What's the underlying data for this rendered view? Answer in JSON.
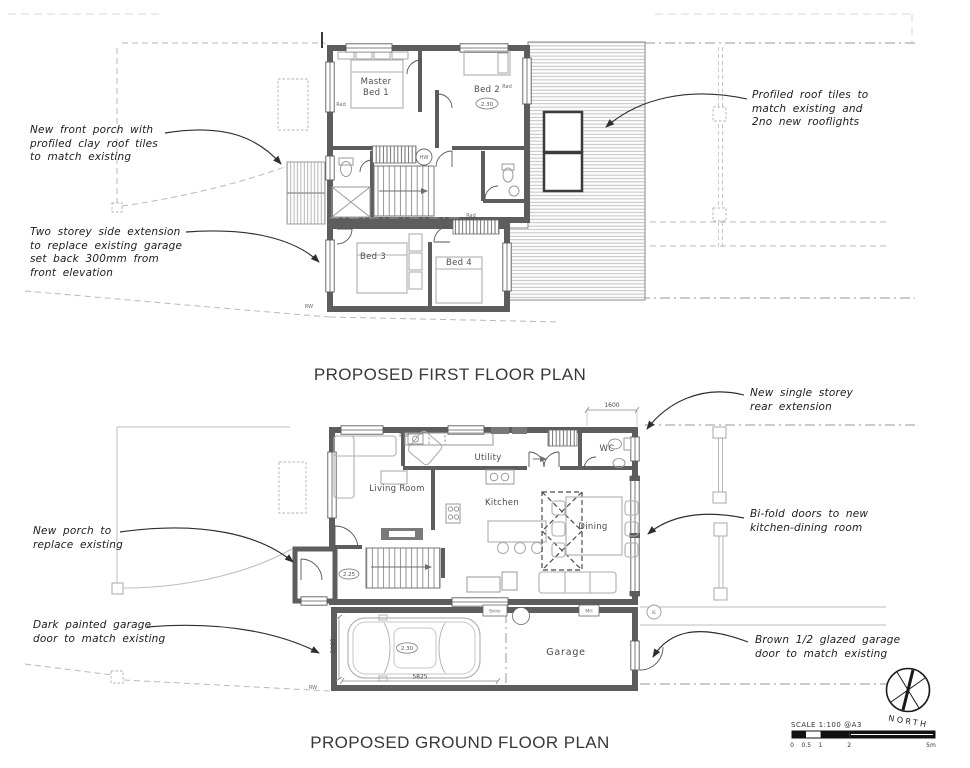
{
  "titles": {
    "first_floor": "PROPOSED FIRST FLOOR PLAN",
    "ground_floor": "PROPOSED GROUND FLOOR PLAN"
  },
  "annotations": {
    "front_porch": "New front porch with\nprofiled clay roof tiles\nto match existing",
    "side_extension": "Two storey side extension\nto replace existing garage\nset back 300mm from\nfront elevation",
    "roof_tiles": "Profiled roof tiles to\nmatch existing and\n2no new rooflights",
    "rear_extension": "New single storey\nrear extension",
    "bifold_doors": "Bi-fold doors to new\nkitchen-dining room",
    "new_porch": "New porch to\nreplace existing",
    "garage_door_dark": "Dark painted garage\ndoor to match existing",
    "garage_door_brown": "Brown 1/2 glazed garage\ndoor to match existing"
  },
  "first_floor": {
    "rooms": {
      "master_line1": "Master",
      "master_line2": "Bed 1",
      "bed2": "Bed 2",
      "bed3": "Bed 3",
      "bed4": "Bed 4"
    },
    "markers": {
      "bed2_height": "2.30",
      "hw": "HW",
      "rad": "Rad",
      "rw": "RW"
    }
  },
  "ground_floor": {
    "rooms": {
      "living": "Living Room",
      "utility": "Utility",
      "wc": "WC",
      "kitchen": "Kitchen",
      "dining": "Dining",
      "garage": "Garage"
    },
    "markers": {
      "hall_height": "2.25",
      "garage_height": "2.30",
      "boiler": "Boiler",
      "mh": "MH",
      "ie": "IE",
      "rad": "Rad",
      "rw": "RW"
    },
    "dimensions": {
      "rear": "1600",
      "garage_width": "5825",
      "garage_depth": "3065"
    }
  },
  "scale": {
    "label": "SCALE 1:100 @A3",
    "ticks": [
      "0",
      "0.5",
      "1",
      "2",
      "5m"
    ]
  },
  "north": {
    "label": "NORTH"
  },
  "colors": {
    "wall": "#5d5d5d",
    "linework": "#9a9a9a",
    "text": "#1f1f1f"
  }
}
